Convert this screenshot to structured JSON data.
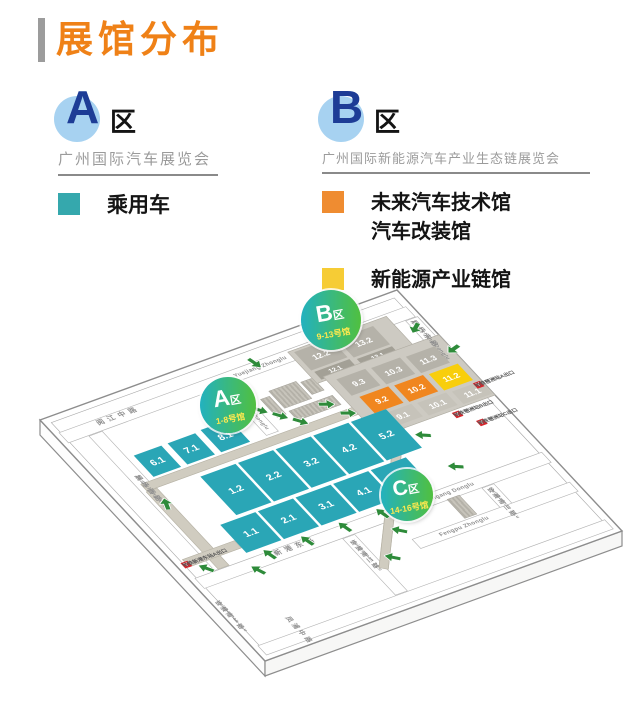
{
  "header": {
    "title": "展馆分布"
  },
  "legend": {
    "zone_a": {
      "letter": "A",
      "suffix": "区",
      "subtitle": "广州国际汽车展览会",
      "items": [
        {
          "color": "#35a8ad",
          "lines": [
            "乘用车"
          ]
        }
      ]
    },
    "zone_b": {
      "letter": "B",
      "suffix": "区",
      "subtitle": "广州国际新能源汽车产业生态链展览会",
      "items": [
        {
          "color": "#ef8c31",
          "lines": [
            "未来汽车技术馆",
            "汽车改装馆"
          ]
        },
        {
          "color": "#f6cc35",
          "lines": [
            "新能源产业链馆"
          ]
        }
      ]
    }
  },
  "map": {
    "zones": {
      "a": {
        "letter": "A",
        "suffix": "区",
        "range": "1-8号馆"
      },
      "b": {
        "letter": "B",
        "suffix": "区",
        "range": "9-13号馆"
      },
      "c": {
        "letter": "C",
        "suffix": "区",
        "range": "14-16号馆"
      }
    },
    "streets": {
      "yuejiang_cn": "阅江中路",
      "yuejiang_py": "Yuejiang Zhonglu",
      "zhanchang_xilu_cn": "展场西路",
      "zhanchang_xilu_py": "Zhanchang Xilu",
      "zhanchang_zhonglu_cn": "展场中路",
      "zhanchang_zhonglu_py": "Zhanchang Zhonglu",
      "zhanchang_donglu_cn": "展场东路",
      "zhanchang_donglu_py": "Zhanchang Donglu",
      "xingang_cn": "新港东路",
      "xingang_py": "Xingang Donglu",
      "huizhannan2_cn": "会展南二路",
      "huizhannan2_py": "Huizhannan 2 Lu",
      "huizhannan3_cn": "会展南三路",
      "huizhannan3_py": "Huizhannan 3 Lu",
      "huizhannan1_cn": "会展南一路",
      "huizhannan1_py": "Huizhannan 1 Lu",
      "fengpu_cn": "凤浦中路",
      "fengpu_py": "Fengpu Zhonglu"
    },
    "halls": {
      "a_top": [
        "6.1",
        "7.1",
        "8.1"
      ],
      "a_mid": [
        "1.2",
        "2.2",
        "3.2",
        "4.2",
        "5.2"
      ],
      "a_bottom": [
        "1.1",
        "2.1",
        "3.1",
        "4.1",
        "5.1"
      ],
      "b_back": [
        "12.2",
        "13.2"
      ],
      "b_back_front": [
        "12.1",
        "13.1"
      ],
      "b_row3": [
        "9.3",
        "10.3",
        "11.3"
      ],
      "b_row2": [
        "9.2",
        "10.2",
        "11.2"
      ],
      "b_row1": [
        "9.1",
        "10.1",
        "11.1"
      ]
    },
    "metro": {
      "icon_glyph": "Y",
      "pazhou_a": "地铁琶洲站A出口",
      "pazhou_b": "地铁琶洲站B出口",
      "pazhou_c": "地铁琶洲站C出口",
      "xingangdong_a": "地铁新港东站A出口"
    }
  },
  "colors": {
    "title_orange": "#ef8117",
    "legend_teal": "#35a8ad",
    "legend_orange": "#ef8c31",
    "legend_yellow": "#f6cc35",
    "hall_teal": "#2aa6b6",
    "hall_orange": "#f0861f",
    "hall_yellow": "#f8ce0c",
    "hall_gray": "#b5b2a9",
    "zone_circle_gradient": [
      "#1fb0c9",
      "#54c135"
    ],
    "zone_range_yellow": "#ffe94f",
    "arrow_green": "#2e8b3a",
    "metro_red": "#d8252c",
    "badge_blue_bg": "#a7d2f1",
    "badge_blue_letter": "#1d3c96"
  }
}
